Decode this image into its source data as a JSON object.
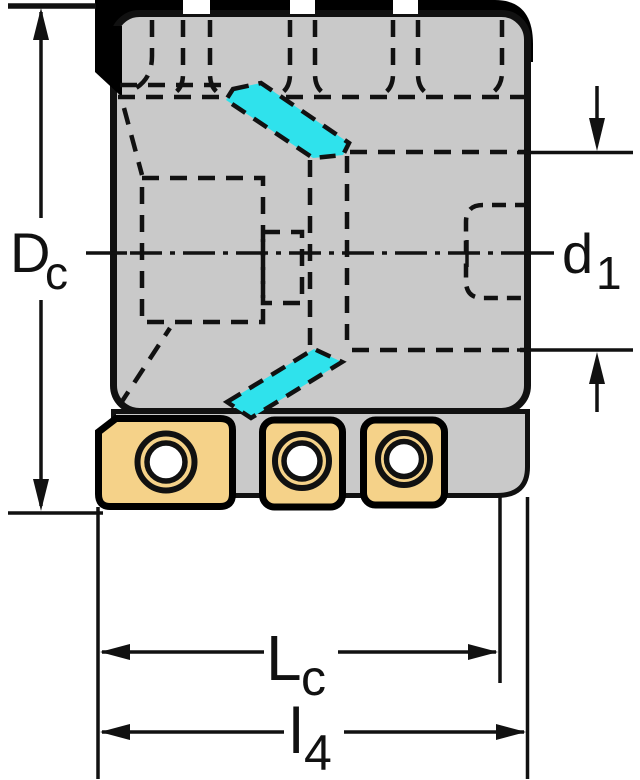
{
  "drawing": {
    "labels": {
      "dc": {
        "main": "D",
        "sub": "c"
      },
      "d1": {
        "main": "d",
        "sub": "1"
      },
      "lc": {
        "main": "L",
        "sub": "c"
      },
      "l4": {
        "main": "l",
        "sub": "4"
      }
    },
    "colors": {
      "background": "#ffffff",
      "body": "#c9c9c9",
      "outline": "#111111",
      "insert_fill": "#f5d289",
      "flute_highlight": "#2fe2ec",
      "hole_fill": "#ffffff"
    }
  }
}
